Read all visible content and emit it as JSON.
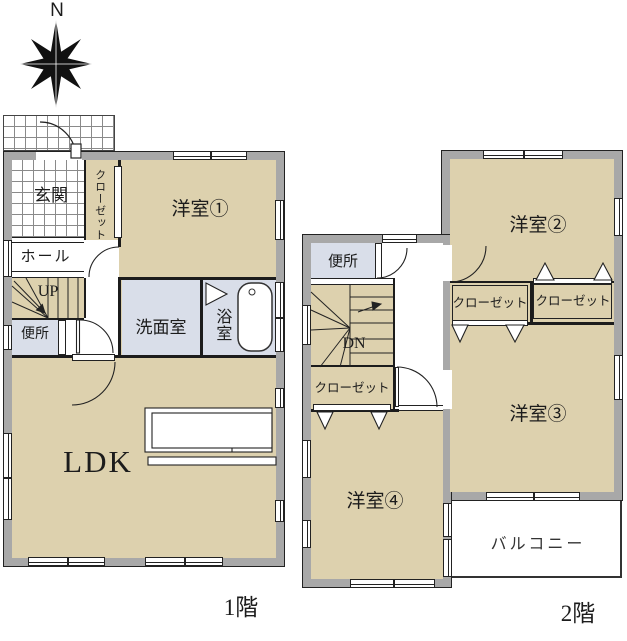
{
  "compass": {
    "north_label": "N"
  },
  "colors": {
    "room_tan": "#ddd1ae",
    "wet_area_blue": "#d9dee9",
    "wall_gray": "#a8a8a8",
    "line": "#1c1c1c"
  },
  "floor1": {
    "caption": "1階",
    "rooms": {
      "entrance": "玄関",
      "closet": "クローゼット",
      "western_room_1": "洋室①",
      "hall": "ホール",
      "stairs": "UP",
      "toilet": "便所",
      "washroom": "洗面室",
      "bathroom": "浴室",
      "ldk": "LDK"
    }
  },
  "floor2": {
    "caption": "2階",
    "rooms": {
      "toilet": "便所",
      "western_room_2": "洋室②",
      "closet_top_left": "クローゼット",
      "closet_top_right": "クローゼット",
      "stairs": "DN",
      "closet_lower": "クローゼット",
      "western_room_3": "洋室③",
      "western_room_4": "洋室④",
      "balcony": "バルコニー"
    }
  }
}
